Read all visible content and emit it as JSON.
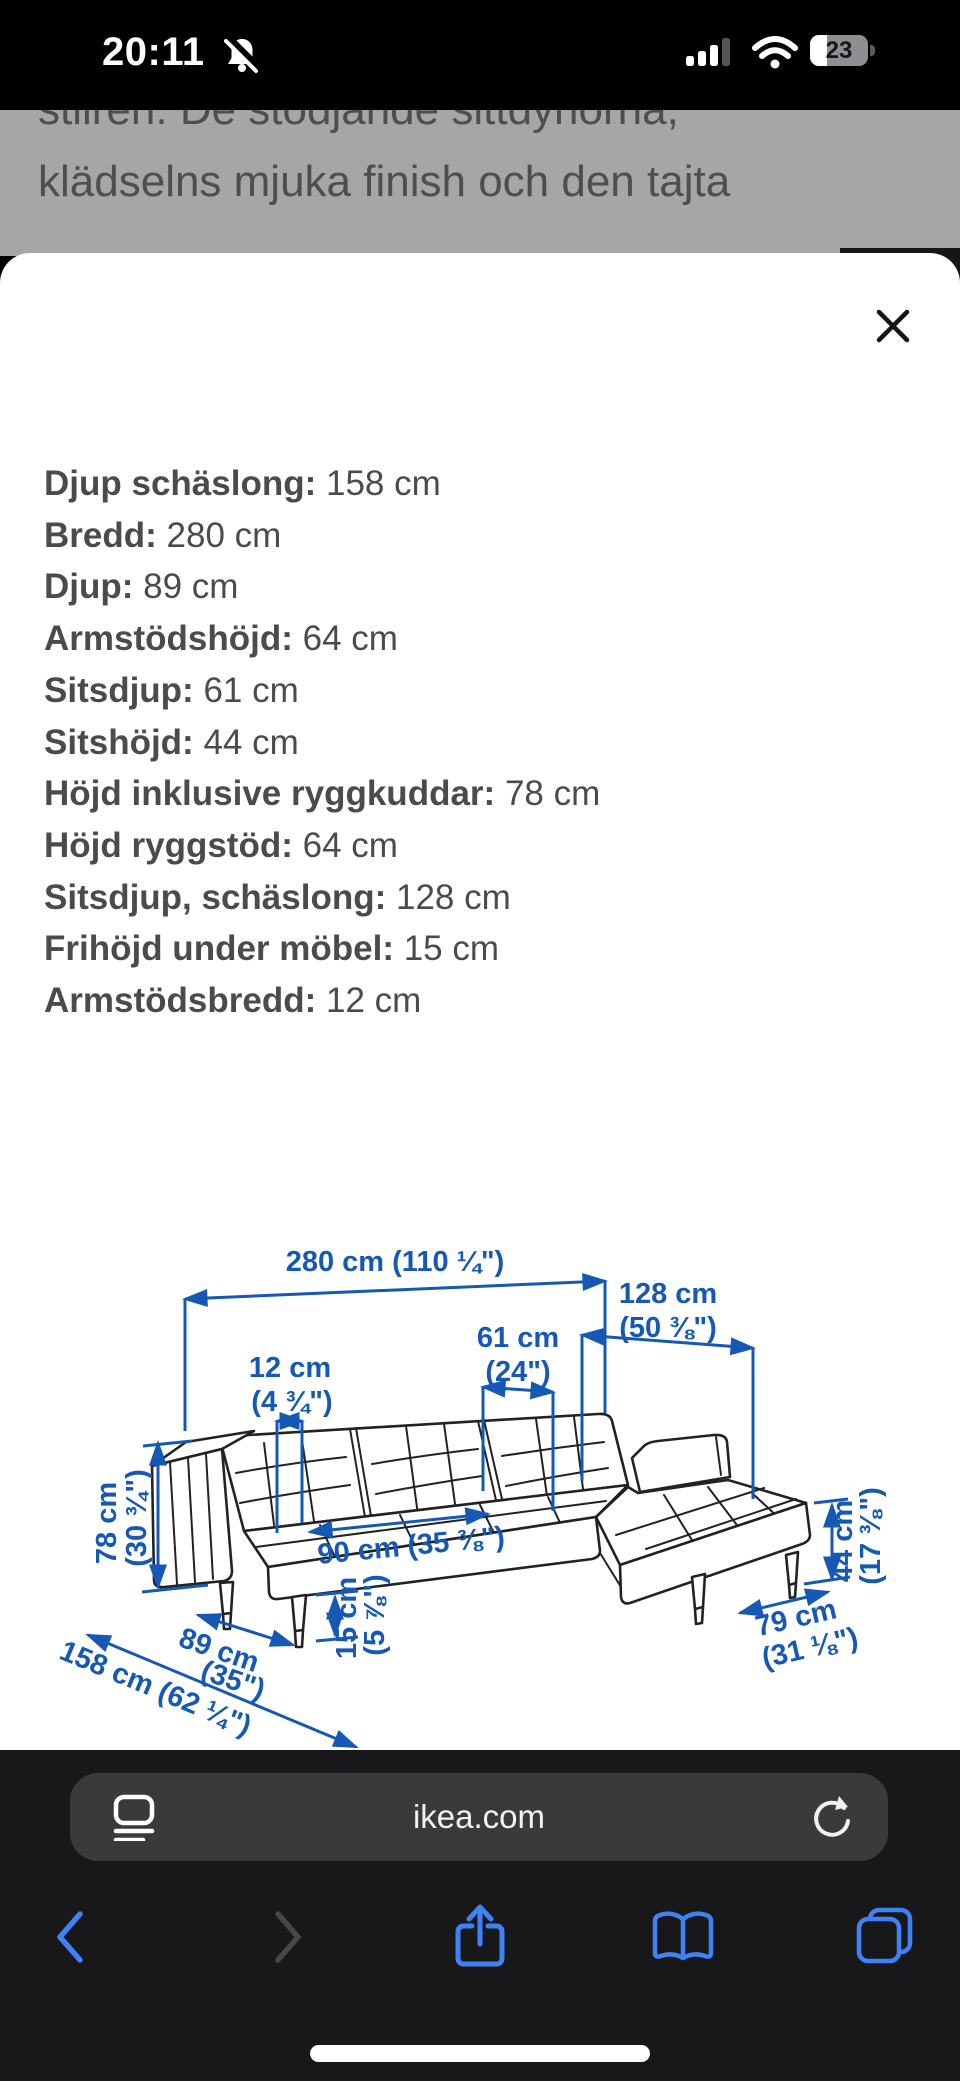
{
  "status_bar": {
    "time": "20:11",
    "battery_level": "23",
    "icons": [
      "notifications-muted-icon",
      "cellular-signal-icon",
      "wifi-icon",
      "battery-icon"
    ]
  },
  "colors": {
    "diagram_blue": "#1659b5",
    "ios_blue": "#3e82f6",
    "text_gray": "#4b4b4b",
    "dim_overlay_gray": "#a6a6a6"
  },
  "page_behind": {
    "paragraph_line1": "stilren. De stödjande sittdynorna,",
    "paragraph_line2": "klädselns mjuka finish och den tajta"
  },
  "sheet": {
    "measurements": [
      {
        "label": "Djup schäslong:",
        "value": "158 cm"
      },
      {
        "label": "Bredd:",
        "value": "280 cm"
      },
      {
        "label": "Djup:",
        "value": "89 cm"
      },
      {
        "label": "Armstödshöjd:",
        "value": "64 cm"
      },
      {
        "label": "Sitsdjup:",
        "value": "61 cm"
      },
      {
        "label": "Sitshöjd:",
        "value": "44 cm"
      },
      {
        "label": "Höjd inklusive ryggkuddar:",
        "value": "78 cm"
      },
      {
        "label": "Höjd ryggstöd:",
        "value": "64 cm"
      },
      {
        "label": "Sitsdjup, schäslong:",
        "value": "128 cm"
      },
      {
        "label": "Frihöjd under möbel:",
        "value": "15 cm"
      },
      {
        "label": "Armstödsbredd:",
        "value": "12 cm"
      }
    ],
    "diagram": {
      "total_width": "280 cm (110 ¼\")",
      "seat_width": {
        "cm": "61 cm",
        "in": "(24\")"
      },
      "chaise_seat_depth": {
        "cm": "128 cm",
        "in": "(50 ⅜\")"
      },
      "armrest_width": {
        "cm": "12 cm",
        "in": "(4 ¾\")"
      },
      "height_back": {
        "cm": "78 cm",
        "in": "(30 ¾\")"
      },
      "seat_depth": "90 cm (35 ⅜\")",
      "clearance": {
        "cm": "15 cm",
        "in": "(5 ⅞\")"
      },
      "depth": {
        "cm": "89 cm",
        "in": "(35\")"
      },
      "chaise_depth_total": "158 cm (62 ¼\")",
      "seat_height": {
        "cm": "44 cm",
        "in": "(17 ⅜\")"
      },
      "chaise_width": {
        "cm": "79 cm",
        "in": "(31 ⅛\")"
      }
    }
  },
  "browser": {
    "url": "ikea.com"
  }
}
